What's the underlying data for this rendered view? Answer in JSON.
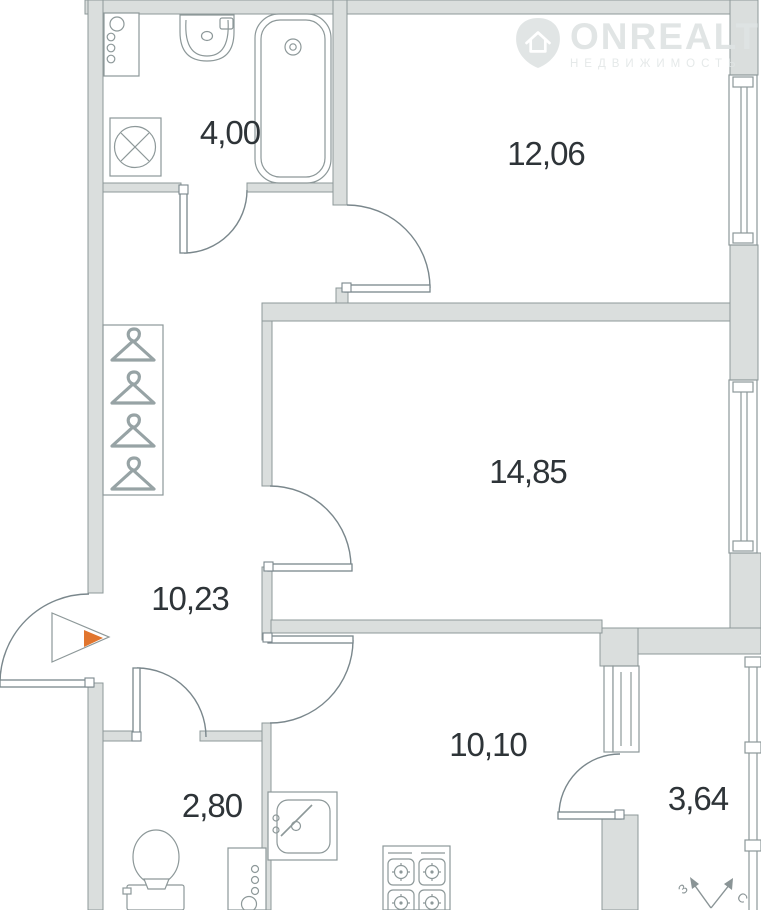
{
  "rooms": {
    "bathroom": "4,00",
    "bedroom": "12,06",
    "living_room": "14,85",
    "hallway": "10,23",
    "kitchen": "10,10",
    "wc": "2,80",
    "balcony": "3,64"
  },
  "watermark": {
    "brand": "ONREALT",
    "subtitle": "НЕДВИЖИМОСТЬ"
  },
  "compass": {
    "west": "З",
    "north": "С"
  },
  "colors": {
    "wall_fill": "#dadedd",
    "wall_stroke": "#8d9899",
    "line": "#8d9899",
    "accent": "#e1752e",
    "label_text": "#2e3438",
    "watermark": "#e3e7e7"
  }
}
